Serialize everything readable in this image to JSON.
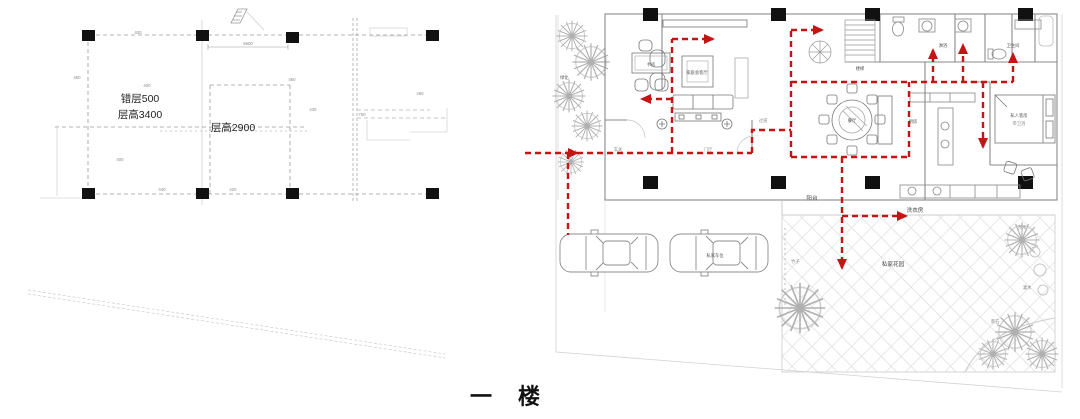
{
  "title": "一 楼",
  "colors": {
    "circulation_red": "#c41414",
    "column_black": "#111111"
  },
  "left_plan": {
    "split_level_label": "错层500",
    "floor_height_label": "层高3400",
    "floor_height2_label": "层高2900",
    "dims": [
      "400",
      "5600",
      "450",
      "400",
      "460",
      "430",
      "260",
      "750",
      "400",
      "440",
      "420"
    ]
  },
  "right_plan": {
    "greenery_label": "绿化",
    "study_label": "书房",
    "living_label": "家庭会客厅",
    "dining_label": "餐厅",
    "kitchen_label": "厨房",
    "stairs_label": "楼梯",
    "shower_label": "淋浴",
    "bathroom_label": "卫生间",
    "guest_room_label": "私人客房",
    "guest_room_sub_label": "带卫浴",
    "foyer_label": "玄关",
    "hall_label": "门厅",
    "corridor_label": "过道",
    "balcony_label": "阳台",
    "laundry_label": "洗衣房",
    "garden_label": "私家花园",
    "parking_label": "私家车位",
    "bamboo_label": "竹子",
    "tree_label": "乔木",
    "shrub_label": "灌木",
    "rock_label": "景石"
  }
}
